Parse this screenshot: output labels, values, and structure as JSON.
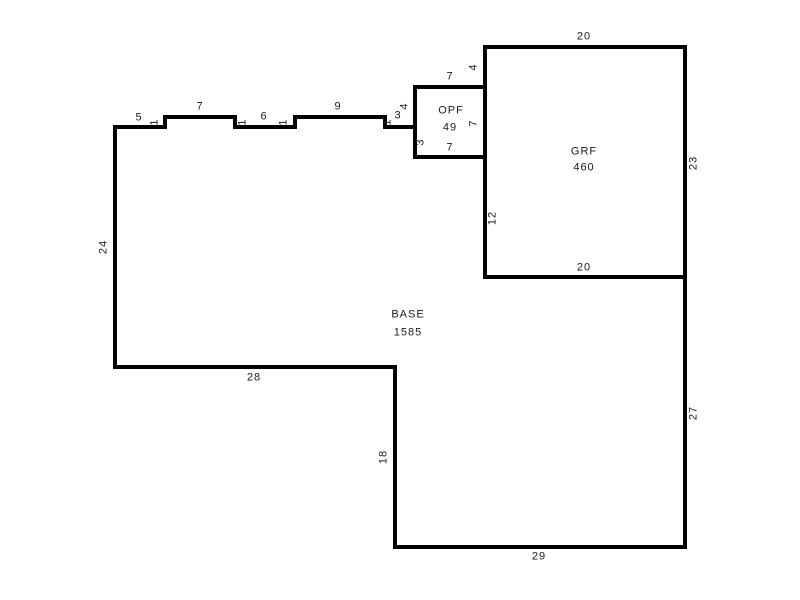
{
  "canvas": {
    "width": 800,
    "height": 600,
    "background": "#ffffff"
  },
  "style": {
    "wall_color": "#000000",
    "wall_thickness": 4,
    "label_color": "#1a1a1a",
    "area_fill": "#ffffff"
  },
  "areas": [
    {
      "id": "base",
      "name": "BASE",
      "value": "1585",
      "name_pos": [
        408,
        315
      ],
      "value_pos": [
        408,
        333
      ]
    },
    {
      "id": "grf",
      "name": "GRF",
      "value": "460",
      "name_pos": [
        584,
        152
      ],
      "value_pos": [
        584,
        168
      ]
    },
    {
      "id": "opf",
      "name": "OPF",
      "value": "49",
      "name_pos": [
        451,
        111
      ],
      "value_pos": [
        450,
        128
      ]
    }
  ],
  "shapes": [
    {
      "id": "base",
      "points": [
        [
          115,
          127
        ],
        [
          115,
          367
        ],
        [
          395,
          367
        ],
        [
          395,
          547
        ],
        [
          685,
          547
        ],
        [
          685,
          277
        ],
        [
          485,
          277
        ],
        [
          485,
          157
        ],
        [
          415,
          157
        ],
        [
          415,
          127
        ],
        [
          385,
          127
        ],
        [
          385,
          117
        ],
        [
          295,
          117
        ],
        [
          295,
          127
        ],
        [
          235,
          127
        ],
        [
          235,
          117
        ],
        [
          165,
          117
        ],
        [
          165,
          127
        ]
      ]
    },
    {
      "id": "grf",
      "points": [
        [
          485,
          47
        ],
        [
          685,
          47
        ],
        [
          685,
          277
        ],
        [
          485,
          277
        ]
      ]
    },
    {
      "id": "opf",
      "points": [
        [
          415,
          87
        ],
        [
          485,
          87
        ],
        [
          485,
          157
        ],
        [
          415,
          157
        ]
      ]
    }
  ],
  "dimension_labels": [
    {
      "text": "5",
      "x": 139,
      "y": 118,
      "rotated": false
    },
    {
      "text": "1",
      "x": 155,
      "y": 122,
      "rotated": true
    },
    {
      "text": "7",
      "x": 200,
      "y": 107,
      "rotated": false
    },
    {
      "text": "1",
      "x": 243,
      "y": 122,
      "rotated": true
    },
    {
      "text": "6",
      "x": 264,
      "y": 117,
      "rotated": false
    },
    {
      "text": "1",
      "x": 284,
      "y": 122,
      "rotated": true
    },
    {
      "text": "9",
      "x": 338,
      "y": 107,
      "rotated": false
    },
    {
      "text": "1",
      "x": 388,
      "y": 122,
      "rotated": true
    },
    {
      "text": "3",
      "x": 398,
      "y": 116,
      "rotated": false
    },
    {
      "text": "4",
      "x": 405,
      "y": 106,
      "rotated": true
    },
    {
      "text": "3",
      "x": 421,
      "y": 142,
      "rotated": true
    },
    {
      "text": "7",
      "x": 450,
      "y": 77,
      "rotated": false
    },
    {
      "text": "4",
      "x": 474,
      "y": 67,
      "rotated": true
    },
    {
      "text": "7",
      "x": 474,
      "y": 123,
      "rotated": true
    },
    {
      "text": "7",
      "x": 450,
      "y": 148,
      "rotated": false
    },
    {
      "text": "20",
      "x": 584,
      "y": 37,
      "rotated": false
    },
    {
      "text": "23",
      "x": 694,
      "y": 163,
      "rotated": true
    },
    {
      "text": "20",
      "x": 584,
      "y": 268,
      "rotated": false
    },
    {
      "text": "12",
      "x": 493,
      "y": 218,
      "rotated": true
    },
    {
      "text": "24",
      "x": 104,
      "y": 247,
      "rotated": true
    },
    {
      "text": "28",
      "x": 254,
      "y": 378,
      "rotated": false
    },
    {
      "text": "18",
      "x": 384,
      "y": 457,
      "rotated": true
    },
    {
      "text": "29",
      "x": 539,
      "y": 557,
      "rotated": false
    },
    {
      "text": "27",
      "x": 694,
      "y": 413,
      "rotated": true
    }
  ]
}
